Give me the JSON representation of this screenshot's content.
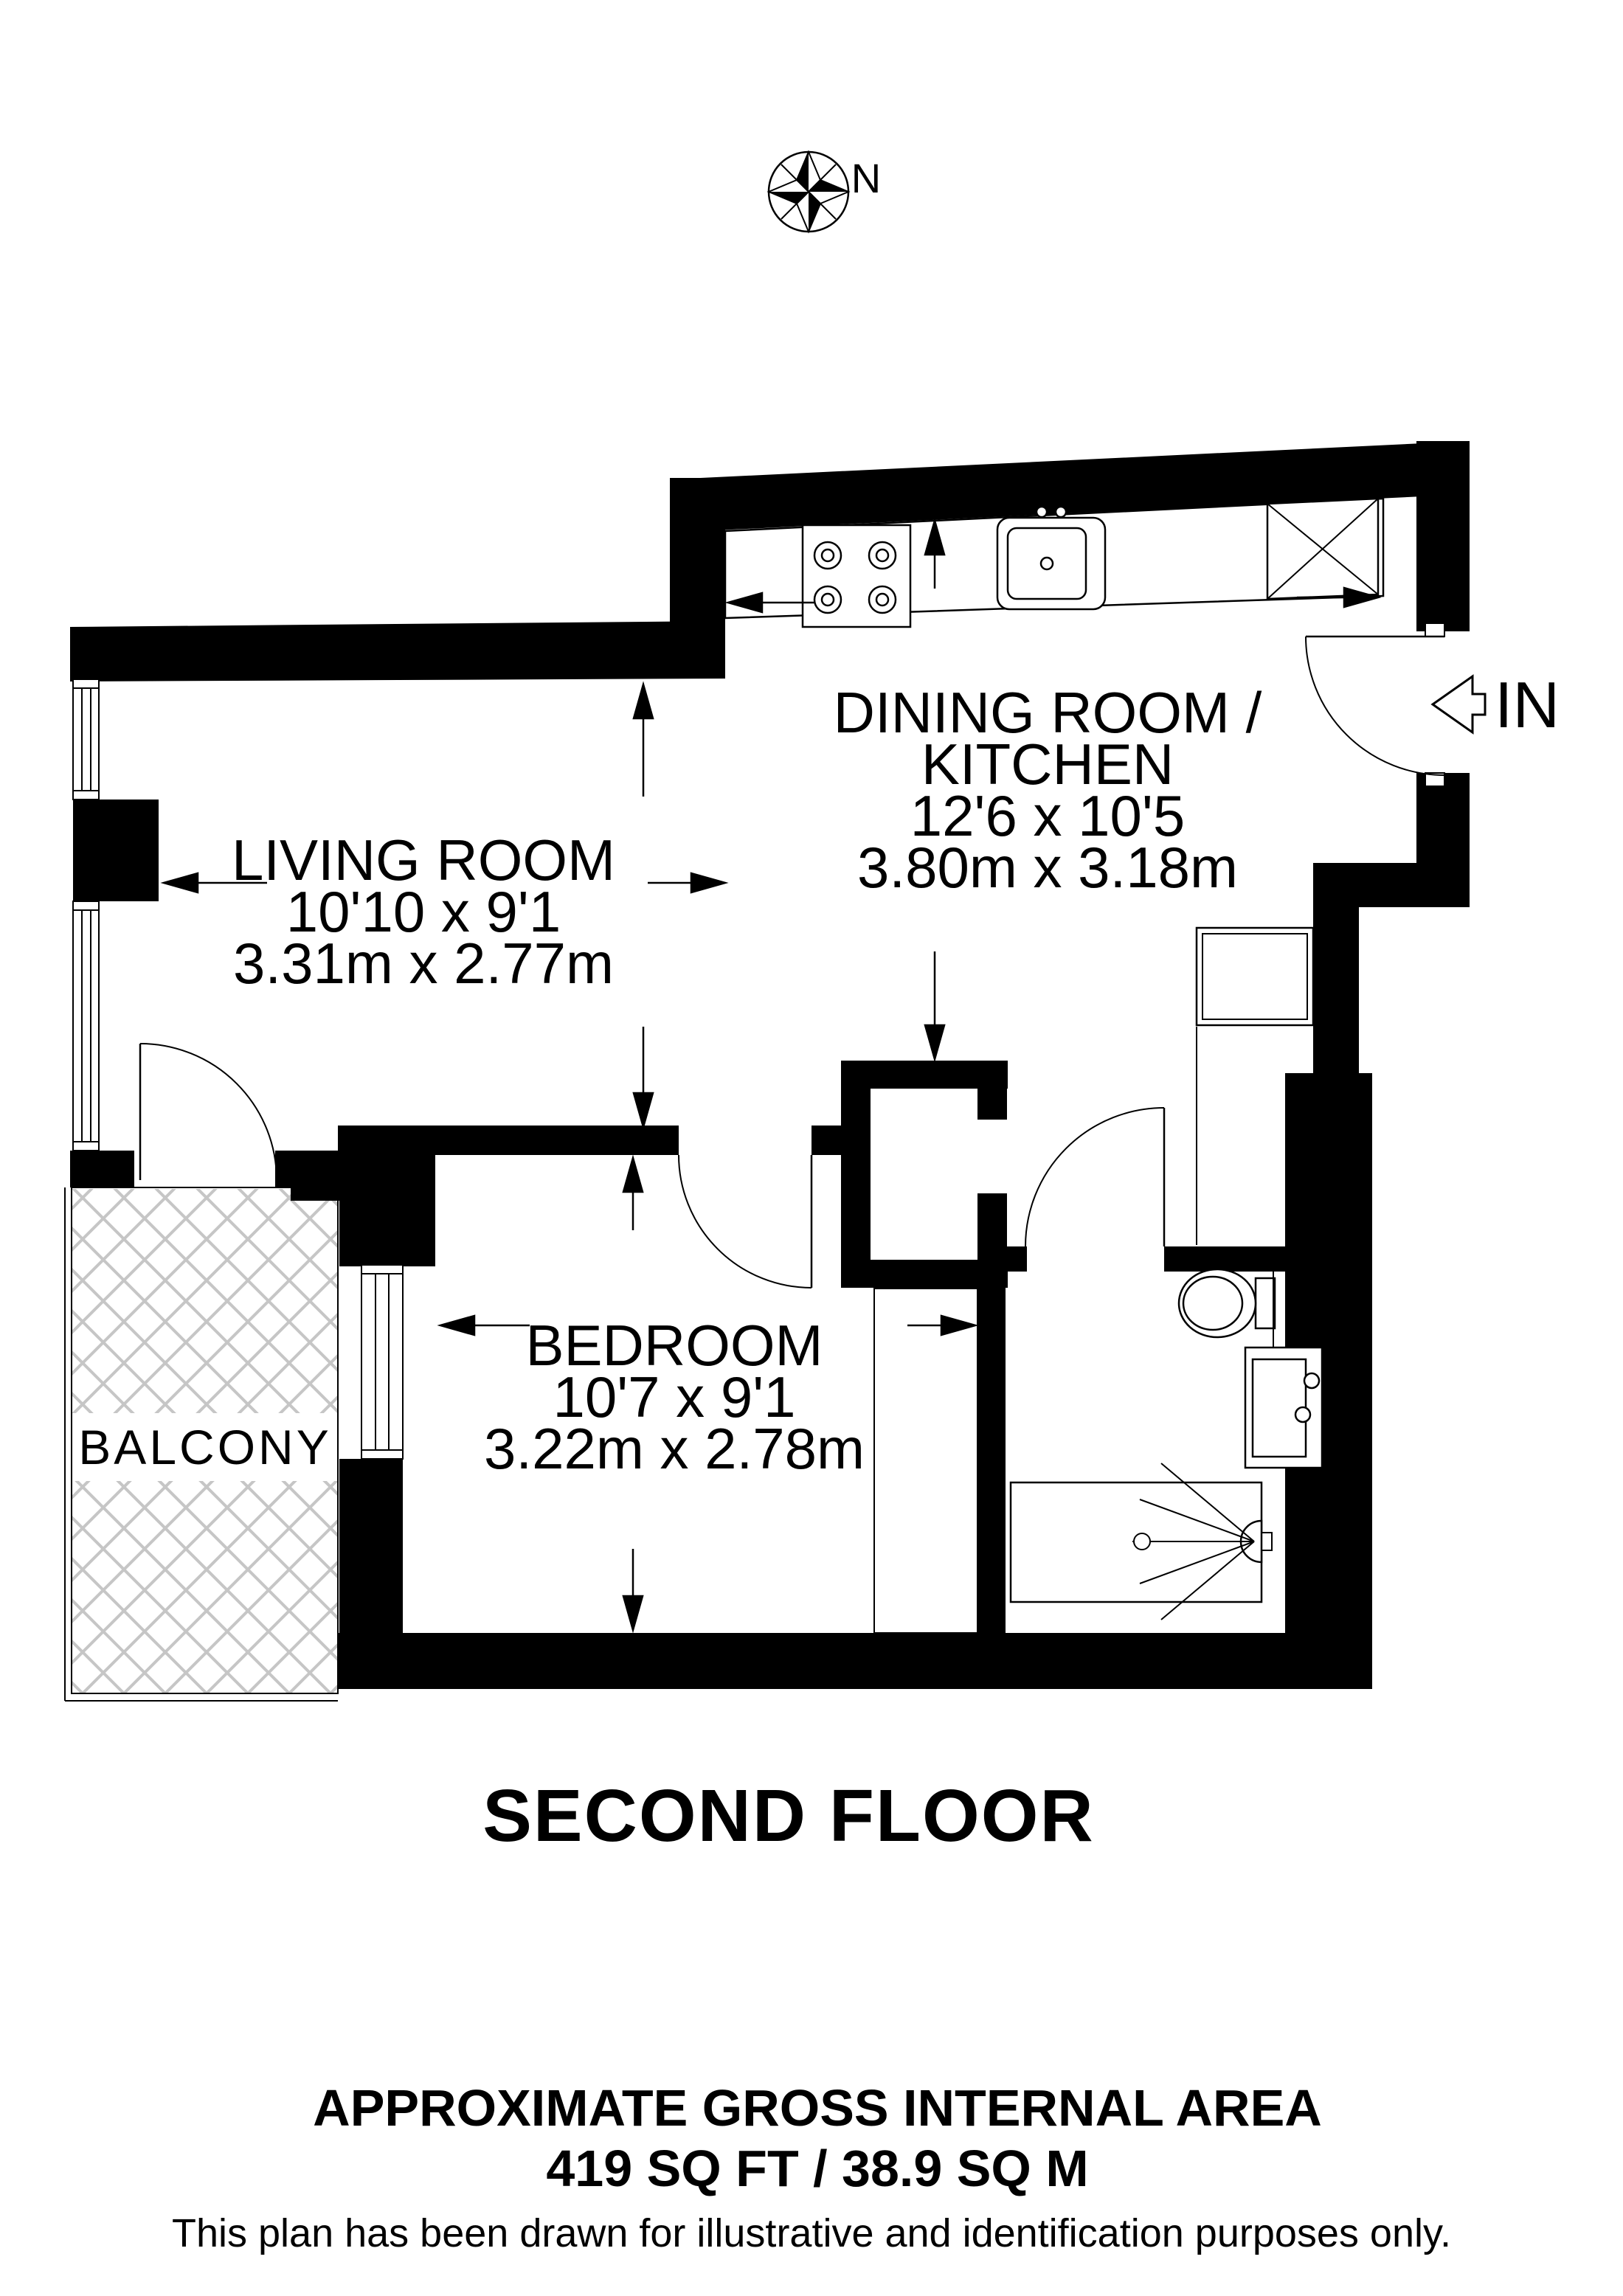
{
  "compass": {
    "north_label": "N"
  },
  "entrance": {
    "label": "IN"
  },
  "rooms": {
    "living": {
      "name": "LIVING ROOM",
      "imperial": "10'10 x 9'1",
      "metric": "3.31m x 2.77m"
    },
    "dining": {
      "name_line1": "DINING ROOM /",
      "name_line2": "KITCHEN",
      "imperial": "12'6 x 10'5",
      "metric": "3.80m x 3.18m"
    },
    "bedroom": {
      "name": "BEDROOM",
      "imperial": "10'7 x 9'1",
      "metric": "3.22m x 2.78m"
    },
    "balcony": {
      "name": "BALCONY"
    }
  },
  "floor_title": "SECOND FLOOR",
  "footer": {
    "area_title": "APPROXIMATE GROSS INTERNAL AREA",
    "area_value": "419 SQ FT / 38.9 SQ M",
    "disclaimer": "This plan has been drawn for illustrative and identification purposes only."
  },
  "icons": {
    "compass": "compass-rose-icon",
    "entrance_arrow": "entrance-arrow-icon",
    "fixtures": [
      "hob-icon",
      "kitchen-sink-icon",
      "appliance-icon",
      "toilet-icon",
      "bathroom-sink-icon",
      "shower-icon"
    ]
  },
  "colors": {
    "wall": "#000000",
    "hatch": "#c6c6c6",
    "background": "#ffffff",
    "text": "#000000"
  }
}
